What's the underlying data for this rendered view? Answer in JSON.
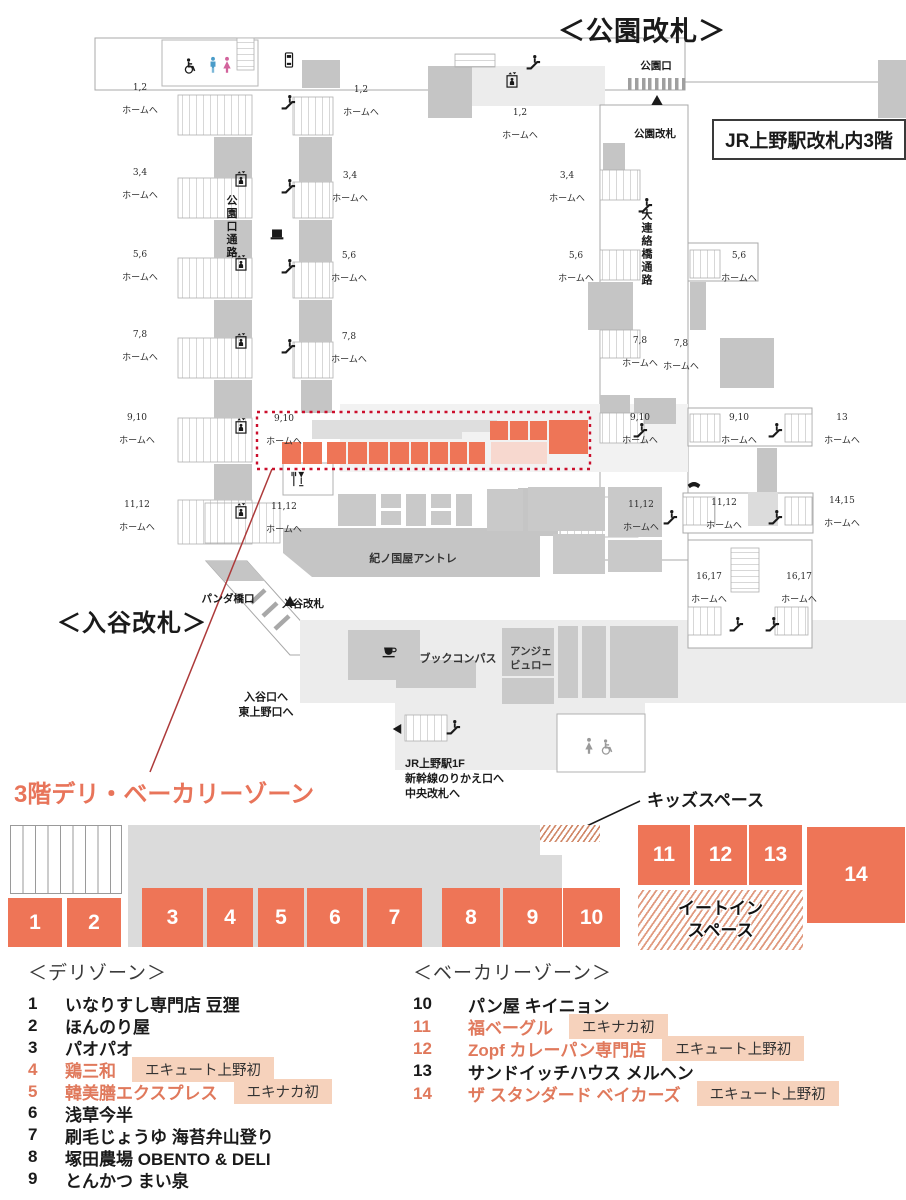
{
  "header": {
    "park_gate_title": "＜公園改札＞",
    "floor_box_label": "JR上野駅改札内3階"
  },
  "map": {
    "iriya_gate_title": "＜入谷改札＞",
    "zone_title": "3階デリ・ベーカリーゾーン",
    "kids_space_label": "キッズスペース",
    "homu_suffix": "ホームへ",
    "platform_labels": [
      {
        "num": "1,2",
        "x": 140,
        "y": 100
      },
      {
        "num": "3,4",
        "x": 140,
        "y": 185
      },
      {
        "num": "5,6",
        "x": 140,
        "y": 267
      },
      {
        "num": "7,8",
        "x": 140,
        "y": 347
      },
      {
        "num": "9,10",
        "x": 137,
        "y": 430
      },
      {
        "num": "11,12",
        "x": 137,
        "y": 517
      },
      {
        "num": "1,2",
        "x": 361,
        "y": 102
      },
      {
        "num": "3,4",
        "x": 350,
        "y": 188
      },
      {
        "num": "5,6",
        "x": 349,
        "y": 268
      },
      {
        "num": "7,8",
        "x": 349,
        "y": 349
      },
      {
        "num": "1,2",
        "x": 520,
        "y": 125
      },
      {
        "num": "3,4",
        "x": 567,
        "y": 188
      },
      {
        "num": "5,6",
        "x": 576,
        "y": 268
      },
      {
        "num": "5,6",
        "x": 739,
        "y": 268
      },
      {
        "num": "7,8",
        "x": 640,
        "y": 353
      },
      {
        "num": "7,8",
        "x": 681,
        "y": 356
      },
      {
        "num": "9,10",
        "x": 284,
        "y": 431
      },
      {
        "num": "9,10",
        "x": 640,
        "y": 430
      },
      {
        "num": "9,10",
        "x": 739,
        "y": 430
      },
      {
        "num": "13",
        "x": 842,
        "y": 430
      },
      {
        "num": "11,12",
        "x": 284,
        "y": 519
      },
      {
        "num": "11,12",
        "x": 641,
        "y": 517
      },
      {
        "num": "11,12",
        "x": 724,
        "y": 515
      },
      {
        "num": "14,15",
        "x": 842,
        "y": 513
      },
      {
        "num": "16,17",
        "x": 709,
        "y": 589
      },
      {
        "num": "16,17",
        "x": 799,
        "y": 589
      }
    ],
    "text_labels": [
      {
        "text": "公園口",
        "x": 656,
        "y": 59,
        "kind": "small"
      },
      {
        "text": "公園改札",
        "x": 655,
        "y": 127,
        "kind": "small"
      },
      {
        "text": "公園口通路",
        "x": 238,
        "y": 227,
        "kind": "vertical"
      },
      {
        "text": "大連絡橋通路",
        "x": 653,
        "y": 248,
        "kind": "vertical"
      },
      {
        "text": "紀ノ国屋アントレ",
        "x": 413,
        "y": 552,
        "kind": "shop"
      },
      {
        "text": "パンダ橋口",
        "x": 228,
        "y": 592,
        "kind": "small"
      },
      {
        "text": "入谷改札",
        "x": 303,
        "y": 597,
        "kind": "small"
      },
      {
        "text": "入谷口へ\n東上野口へ",
        "x": 266,
        "y": 698,
        "kind": "multic"
      },
      {
        "text": "ブックコンパス",
        "x": 458,
        "y": 652,
        "kind": "shop"
      },
      {
        "text": "アンジェ\nビュロー",
        "x": 531,
        "y": 652,
        "kind": "shopl"
      },
      {
        "text": "JR上野駅1F\n新幹線のりかえ口へ\n中央改札へ",
        "x": 405,
        "y": 742,
        "kind": "multi"
      }
    ],
    "icons": [
      {
        "name": "wheelchair-icon",
        "ref": "#sym-wheelchair",
        "x": 190,
        "y": 66
      },
      {
        "name": "toilet-man-icon",
        "ref": "#sym-man",
        "x": 213,
        "y": 65,
        "color": "#4a9cc9"
      },
      {
        "name": "toilet-woman-icon",
        "ref": "#sym-woman",
        "x": 227,
        "y": 65,
        "color": "#d2639c"
      },
      {
        "name": "vending-machine-icon",
        "ref": "#sym-vending",
        "x": 289,
        "y": 60
      },
      {
        "name": "elevator-icon",
        "ref": "#sym-elevator",
        "x": 241,
        "y": 179
      },
      {
        "name": "elevator-icon",
        "ref": "#sym-elevator",
        "x": 241,
        "y": 263
      },
      {
        "name": "elevator-icon",
        "ref": "#sym-elevator",
        "x": 241,
        "y": 341
      },
      {
        "name": "elevator-icon",
        "ref": "#sym-elevator",
        "x": 241,
        "y": 426
      },
      {
        "name": "elevator-icon",
        "ref": "#sym-elevator",
        "x": 241,
        "y": 511
      },
      {
        "name": "elevator-icon",
        "ref": "#sym-elevator",
        "x": 512,
        "y": 80
      },
      {
        "name": "escalator-icon",
        "ref": "#sym-escalator",
        "x": 288,
        "y": 102
      },
      {
        "name": "escalator-icon",
        "ref": "#sym-escalator",
        "x": 288,
        "y": 186
      },
      {
        "name": "escalator-icon",
        "ref": "#sym-escalator",
        "x": 288,
        "y": 266
      },
      {
        "name": "escalator-icon",
        "ref": "#sym-escalator",
        "x": 288,
        "y": 346
      },
      {
        "name": "escalator-icon",
        "ref": "#sym-escalator",
        "x": 533,
        "y": 62
      },
      {
        "name": "escalator-icon",
        "ref": "#sym-escalator",
        "x": 645,
        "y": 205
      },
      {
        "name": "escalator-icon",
        "ref": "#sym-escalator",
        "x": 640,
        "y": 430
      },
      {
        "name": "escalator-icon",
        "ref": "#sym-escalator",
        "x": 775,
        "y": 430
      },
      {
        "name": "escalator-icon",
        "ref": "#sym-escalator",
        "x": 670,
        "y": 517
      },
      {
        "name": "escalator-icon",
        "ref": "#sym-escalator",
        "x": 775,
        "y": 517
      },
      {
        "name": "escalator-icon",
        "ref": "#sym-escalator",
        "x": 736,
        "y": 624
      },
      {
        "name": "escalator-icon",
        "ref": "#sym-escalator",
        "x": 772,
        "y": 624
      },
      {
        "name": "escalator-icon",
        "ref": "#sym-escalator",
        "x": 453,
        "y": 727
      },
      {
        "name": "kiosk-icon",
        "ref": "#sym-kiosk",
        "x": 277,
        "y": 233
      },
      {
        "name": "phone-icon",
        "ref": "#sym-phone",
        "x": 694,
        "y": 487
      },
      {
        "name": "restaurant-icon",
        "ref": "#sym-forkwine",
        "x": 297,
        "y": 479
      },
      {
        "name": "cafe-icon",
        "ref": "#sym-coffee",
        "x": 389,
        "y": 651
      },
      {
        "name": "left-arrow-icon",
        "ref": "#sym-arrowleft",
        "x": 397,
        "y": 729
      },
      {
        "name": "gate-triangle-icon",
        "ref": "#sym-tri",
        "x": 657,
        "y": 100
      },
      {
        "name": "gate-triangle-icon",
        "ref": "#sym-tri",
        "x": 290,
        "y": 601
      },
      {
        "name": "toilet-woman-icon",
        "ref": "#sym-woman",
        "x": 589,
        "y": 746,
        "kind": "gray"
      },
      {
        "name": "wheelchair-icon",
        "ref": "#sym-wheelchair",
        "x": 607,
        "y": 747,
        "kind": "gray"
      }
    ]
  },
  "schematic": {
    "eat_in_label": "イートイン\nスペース",
    "shop_boxes": [
      {
        "num": "1",
        "x": 8,
        "y": 78,
        "w": 54,
        "h": 49
      },
      {
        "num": "2",
        "x": 67,
        "y": 78,
        "w": 54,
        "h": 49
      },
      {
        "num": "3",
        "x": 142,
        "y": 68,
        "w": 61,
        "h": 59
      },
      {
        "num": "4",
        "x": 207,
        "y": 68,
        "w": 46,
        "h": 59
      },
      {
        "num": "5",
        "x": 258,
        "y": 68,
        "w": 46,
        "h": 59
      },
      {
        "num": "6",
        "x": 307,
        "y": 68,
        "w": 56,
        "h": 59
      },
      {
        "num": "7",
        "x": 367,
        "y": 68,
        "w": 55,
        "h": 59
      },
      {
        "num": "8",
        "x": 442,
        "y": 68,
        "w": 58,
        "h": 59
      },
      {
        "num": "9",
        "x": 503,
        "y": 68,
        "w": 59,
        "h": 59
      },
      {
        "num": "10",
        "x": 563,
        "y": 68,
        "w": 57,
        "h": 59
      },
      {
        "num": "11",
        "x": 638,
        "y": 5,
        "w": 52,
        "h": 60
      },
      {
        "num": "12",
        "x": 694,
        "y": 5,
        "w": 53,
        "h": 60
      },
      {
        "num": "13",
        "x": 749,
        "y": 5,
        "w": 53,
        "h": 60
      },
      {
        "num": "14",
        "x": 807,
        "y": 7,
        "w": 98,
        "h": 96
      }
    ]
  },
  "legend": {
    "deli": {
      "title": "＜デリゾーン＞",
      "items": [
        {
          "num": "1",
          "name": "いなりすし専門店 豆狸"
        },
        {
          "num": "2",
          "name": "ほんのり屋"
        },
        {
          "num": "3",
          "name": "パオパオ"
        },
        {
          "num": "4",
          "name": "鶏三和",
          "highlight": true,
          "badge": "エキュート上野初"
        },
        {
          "num": "5",
          "name": "韓美膳エクスプレス",
          "highlight": true,
          "badge": "エキナカ初"
        },
        {
          "num": "6",
          "name": "浅草今半"
        },
        {
          "num": "7",
          "name": "刷毛じょうゆ 海苔弁山登り"
        },
        {
          "num": "8",
          "name": "塚田農場 OBENTO & DELI"
        },
        {
          "num": "9",
          "name": "とんかつ まい泉"
        }
      ]
    },
    "bakery": {
      "title": "＜ベーカリーゾーン＞",
      "items": [
        {
          "num": "10",
          "name": "パン屋 キイニョン"
        },
        {
          "num": "11",
          "name": "福ベーグル",
          "highlight": true,
          "badge": "エキナカ初"
        },
        {
          "num": "12",
          "name": "Zopf カレーパン専門店",
          "highlight": true,
          "badge": "エキュート上野初"
        },
        {
          "num": "13",
          "name": "サンドイッチハウス メルヘン"
        },
        {
          "num": "14",
          "name": "ザ スタンダード ベイカーズ",
          "highlight": true,
          "badge": "エキュート上野初"
        }
      ]
    }
  },
  "colors": {
    "accent_salmon": "#ee7557",
    "highlight_text": "#e0795c",
    "badge_bg": "#f6d2bc",
    "zone_dashed_red": "#cb0f2c",
    "map_gray_block": "#c5c5c5"
  }
}
